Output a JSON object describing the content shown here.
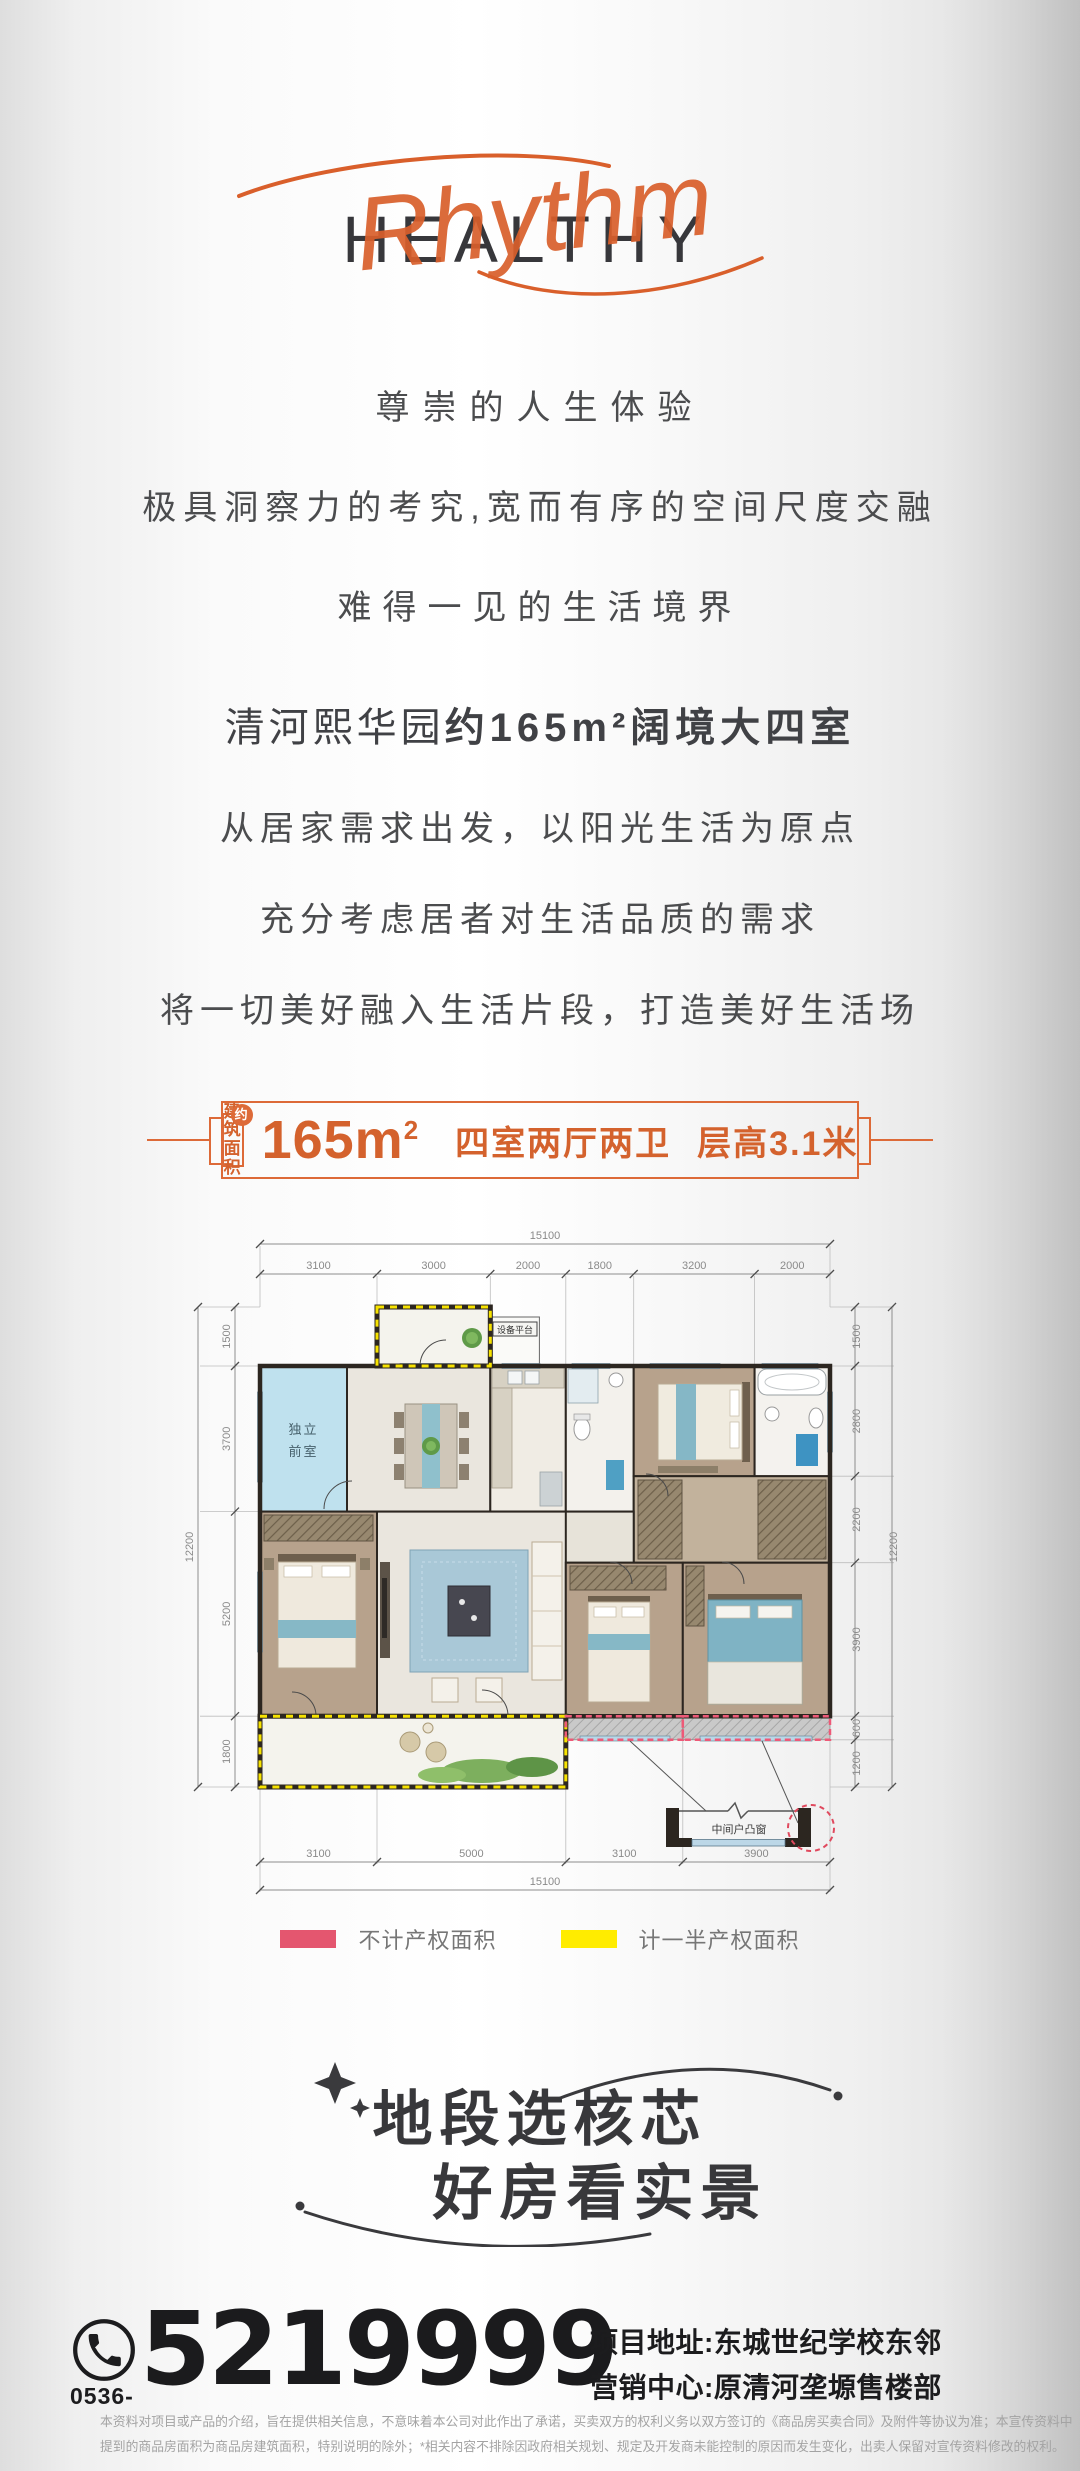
{
  "logo": {
    "wordmark": "HEALTHY",
    "script": "Rhythm",
    "wordmark_color": "#37373b",
    "script_color": "#d95f2b"
  },
  "intro": {
    "line1": "尊崇的人生体验",
    "line2": "极具洞察力的考究,宽而有序的空间尺度交融",
    "line3": "难得一见的生活境界"
  },
  "body": {
    "headline_regular": "清河熙华园",
    "headline_bold": "约165m²阔境大四室",
    "line1": "从居家需求出发，以阳光生活为原点",
    "line2": "充分考虑居者对生活品质的需求",
    "line3": "将一切美好融入生活片段，打造美好生活场"
  },
  "badge": {
    "area_label_line1": "建筑",
    "area_label_line2": "面积",
    "approx_mark": "约",
    "area_value_base": "165m",
    "area_value_sup": "2",
    "layout": "四室两厅两卫",
    "floor_height": "层高3.1米",
    "accent_color": "#dd6a38"
  },
  "floorplan": {
    "front_room_line1": "独立",
    "front_room_line2": "前室",
    "equipment_label": "设备平台",
    "bay_window_label": "中间户凸窗",
    "dims": {
      "top_total": "15100",
      "top_segments": [
        "3100",
        "3000",
        "2000",
        "1800",
        "3200",
        "2000"
      ],
      "bottom_segments": [
        "3100",
        "5000",
        "3100",
        "3900"
      ],
      "bottom_total": "15100",
      "left_segments": [
        "1500",
        "3700",
        "5200",
        "1800"
      ],
      "left_total": "12200",
      "right_segments": [
        "1500",
        "2800",
        "2200",
        "3900",
        "600",
        "1200"
      ],
      "right_total": "12200"
    }
  },
  "legend": {
    "no_property": "不计产权面积",
    "no_property_color": "#e4566f",
    "half_property": "计一半产权面积",
    "half_property_color": "#ffec00"
  },
  "slogan": {
    "line1": "地段选核芯",
    "line2": "好房看实景"
  },
  "contact": {
    "area_code": "0536-",
    "phone": "5219999",
    "address_line1": "项目地址:东城世纪学校东邻",
    "address_line2": "营销中心:原清河垄塬售楼部"
  },
  "disclaimer": {
    "line1": "本资料对项目或产品的介绍，旨在提供相关信息，不意味着本公司对此作出了承诺，买卖双方的权利义务以双方签订的《商品房买卖合同》及附件等协议为准；本宣传资料中",
    "line2": "提到的商品房面积为商品房建筑面积，特别说明的除外；*相关内容不排除因政府相关规划、规定及开发商未能控制的原因而发生变化，出卖人保留对宣传资料修改的权利。"
  }
}
